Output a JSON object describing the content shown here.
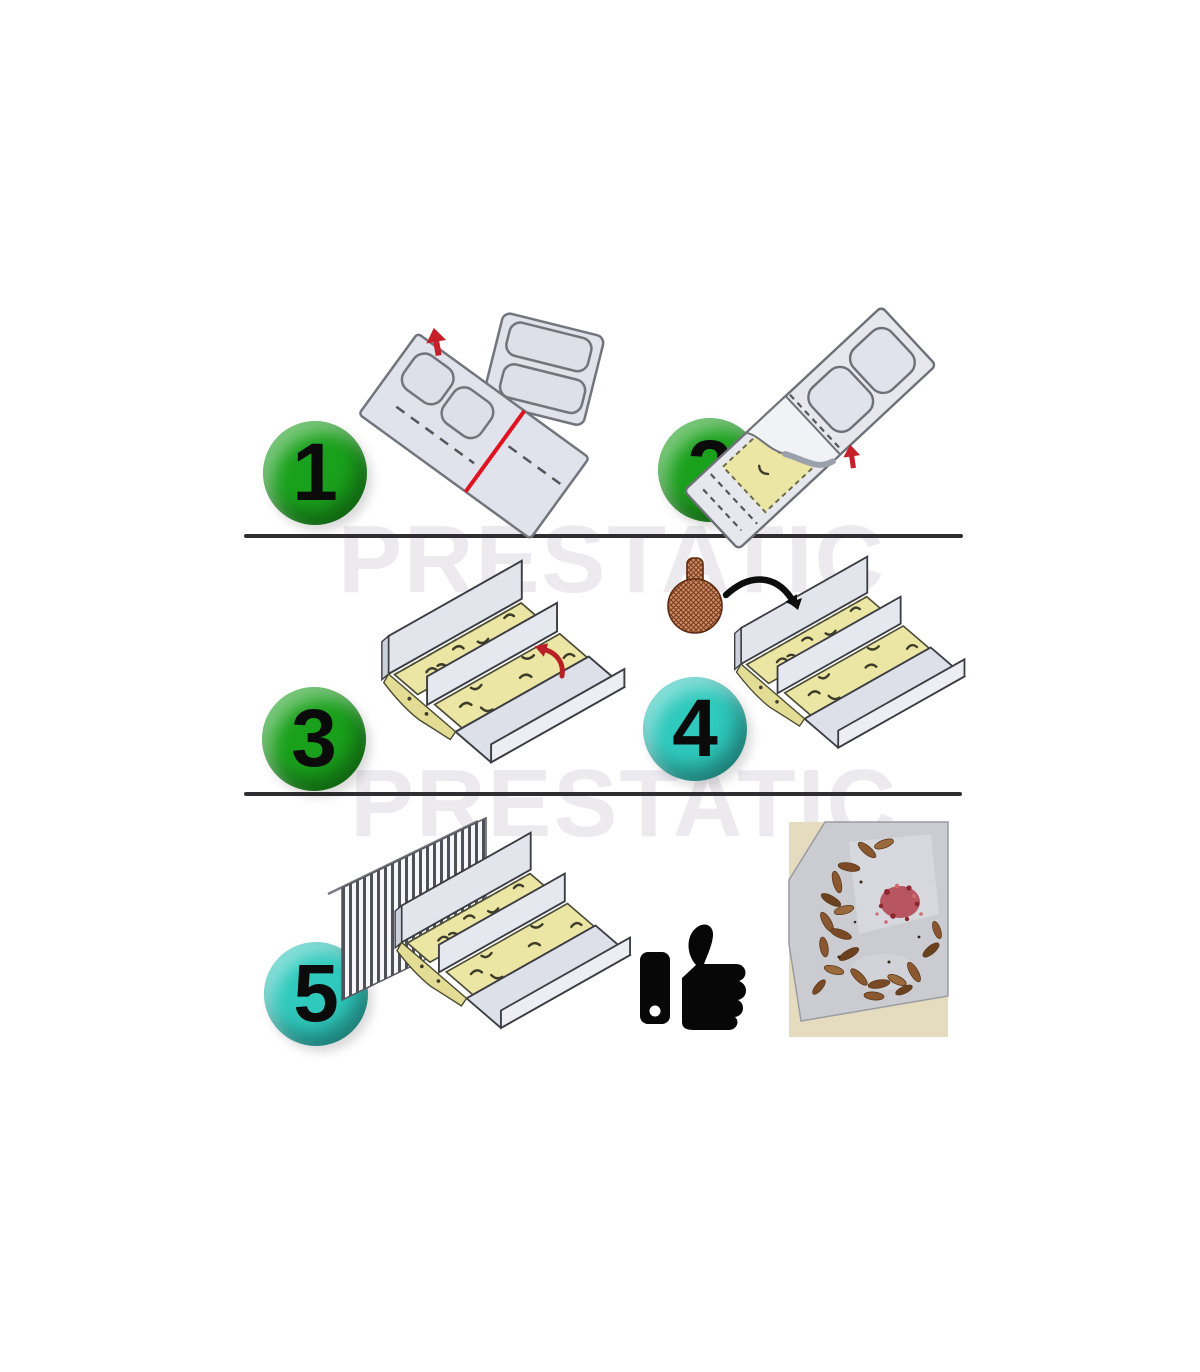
{
  "watermark": {
    "text": "PRESTATIC",
    "color": "#eceaee"
  },
  "steps": [
    {
      "number": "1",
      "badge_color": "#1aa11c"
    },
    {
      "number": "2",
      "badge_color": "#1aa11c"
    },
    {
      "number": "3",
      "badge_color": "#1aa11c"
    },
    {
      "number": "4",
      "badge_color": "#2fc9bd"
    },
    {
      "number": "5",
      "badge_color": "#2fc9bd"
    }
  ],
  "colors": {
    "sticky_pad": "#ebe6a4",
    "cardboard": "#dfe2ea",
    "outline": "#44454b",
    "red_arrow": "#c4232b",
    "bait_ball": "#c98f66",
    "divider_line": "#2f2f33",
    "photo_background": "#e5dbbe",
    "glue_board": "#caccd2",
    "insect_brown": "#7c4c27",
    "bait_pile_red": "#b2404a"
  },
  "icons": {
    "approval": "thumbs-up",
    "bait": "bait-ball",
    "peel_direction": "red-arrow",
    "place_direction": "black-curved-arrow"
  }
}
